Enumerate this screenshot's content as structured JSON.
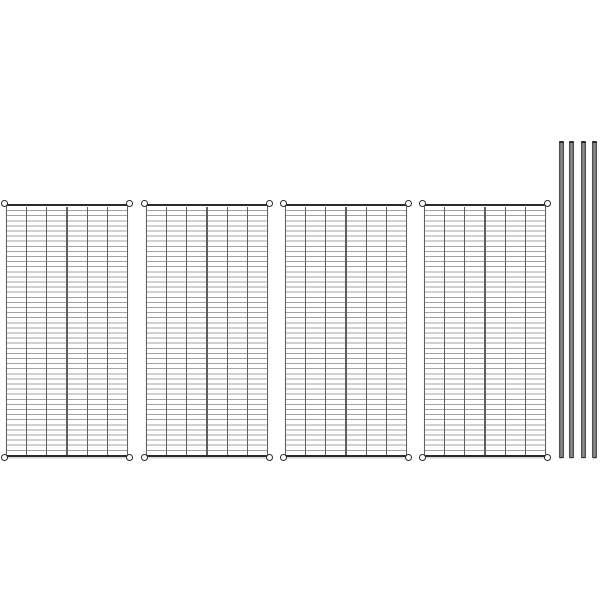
{
  "image": {
    "description": "Product image of a metal wire shelving kit on a plain white background: four identical rectangular chrome-wire shelf panels shown upright side by side, each with a round collar sleeve at all four corners, and four slender cylindrical shelving posts standing vertically at the right edge.",
    "background_color": "#ffffff"
  },
  "colors": {
    "background": "#ffffff",
    "frame_bar": "#2b2b2b",
    "wire_vertical": "#5f5f5f",
    "wire_horizontal": "#a3a3a3",
    "collar_ring": "#2e2e2e",
    "collar_fill": "#ffffff",
    "post_edge": "#414141",
    "post_center": "#8f8f8f",
    "shadow": "rgba(0,0,0,0.16)"
  },
  "scene": {
    "shelves": {
      "count": 4,
      "x": [
        6,
        146,
        285,
        424
      ],
      "y": 204,
      "width": 122,
      "height": 253,
      "columns": 6,
      "row_pitch": 5.1,
      "top_bar_thickness": 2.5,
      "edge_wire_thickness": 1.3,
      "collar_diameter": 8
    },
    "posts": {
      "count": 4,
      "x": [
        559,
        569,
        581,
        592
      ],
      "y": 141,
      "width": 5,
      "height": 317
    }
  }
}
